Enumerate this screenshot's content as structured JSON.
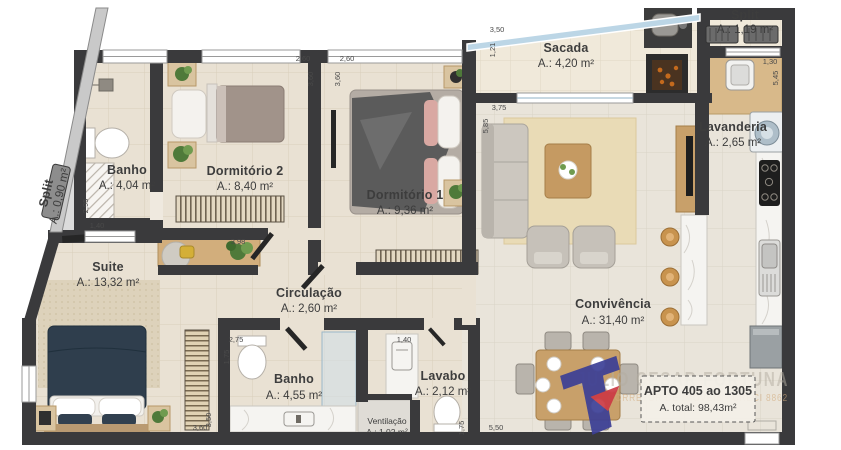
{
  "rooms": [
    {
      "name": "Banho",
      "area": "A.: 4,04 m²"
    },
    {
      "name": "Dormitório 2",
      "area": "A.: 8,40 m²"
    },
    {
      "name": "Dormitório 1",
      "area": "A.: 9,36 m²"
    },
    {
      "name": "Sacada",
      "area": "A.: 4,20 m²"
    },
    {
      "name": "Split",
      "area": "A.: 1,19 m²"
    },
    {
      "name": "Lavanderia",
      "area": "A.: 2,65 m²"
    },
    {
      "name": "Split",
      "area": "A.: 0,90 m²"
    },
    {
      "name": "Suite",
      "area": "A.: 13,32 m²"
    },
    {
      "name": "Circulação",
      "area": "A.: 2,60 m²"
    },
    {
      "name": "Convivência",
      "area": "A.: 31,40 m²"
    },
    {
      "name": "Banho",
      "area": "A.: 4,55 m²"
    },
    {
      "name": "Lavabo",
      "area": "A.: 2,12 m²"
    },
    {
      "name": "Ventilação",
      "area": "A.: 1,02 m²"
    }
  ],
  "dims": [
    "1,40",
    "2,95",
    "2,60",
    "3,60",
    "2,60",
    "3,60",
    "3,50",
    "1,21",
    "3,75",
    "5,85",
    "1,30",
    "5,45",
    "3,98",
    "2,75",
    "1,75",
    "1,40",
    "1,75",
    "5,50",
    "3,60",
    "3,50"
  ],
  "apto": {
    "line1": "APTO 405 ao 1305",
    "line2": "A. total: 98,43m²"
  },
  "watermark": {
    "agent": "JULIO CESAR FORTUNA",
    "creci": "CORRETOR DE IMÓVEIS - CRECI 8862"
  },
  "colors": {
    "wall": "#3a3a3c",
    "floor": "#e9e1d3",
    "accent_blue": "#3c3f96",
    "accent_red": "#cc3a44",
    "glass": "#bcd6e6"
  }
}
